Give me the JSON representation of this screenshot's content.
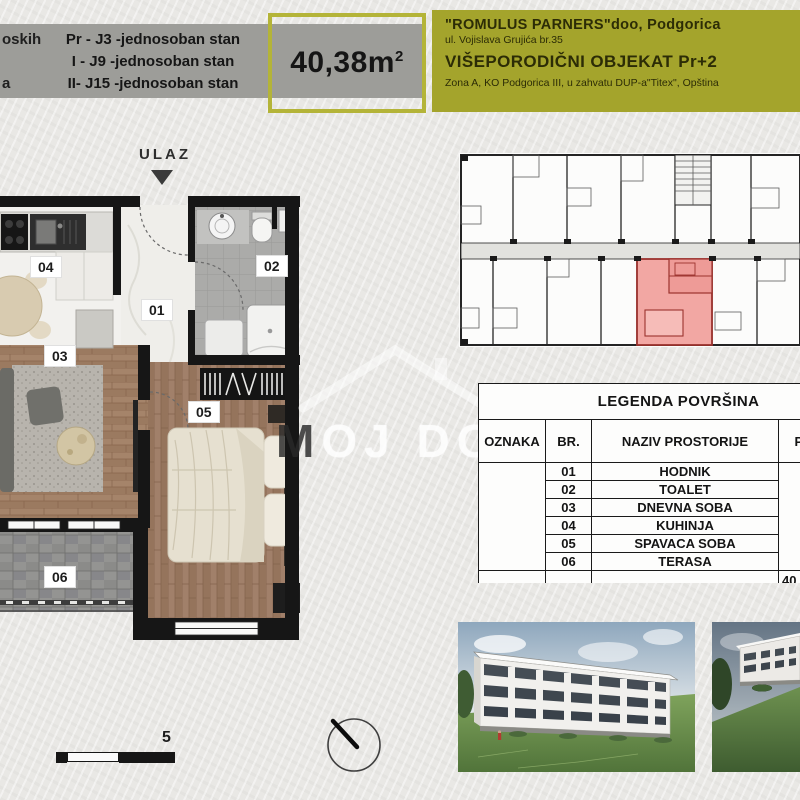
{
  "header": {
    "left_fragments": [
      "oskih",
      "a"
    ],
    "units": [
      "Pr - J3 -jednosoban stan",
      "I - J9 -jednosoban stan",
      "II- J15 -jednosoban stan"
    ],
    "area": {
      "value": "40,38m",
      "sup": "2"
    },
    "company": {
      "line1": "\"ROMULUS PARNERS\"doo, Podgorica",
      "line2": "ul. Vojislava Grujića br.35",
      "line3": "VIŠEPORODIČNI OBJEKAT  Pr+2",
      "line4": "Zona A, KO Podgorica III, u zahvatu DUP-a\"Titex\", Opština"
    },
    "colors": {
      "band_gray": "#9d9d99",
      "olive": "#a4a42c",
      "area_border": "#b4b438"
    }
  },
  "floorplan": {
    "entrance_label": "ULAZ",
    "rooms": [
      {
        "num": "01",
        "name": "HODNIK"
      },
      {
        "num": "02",
        "name": "TOALET"
      },
      {
        "num": "03",
        "name": "DNEVNA SOBA"
      },
      {
        "num": "04",
        "name": "KUHINJA"
      },
      {
        "num": "05",
        "name": "SPAVACA SOBA"
      },
      {
        "num": "06",
        "name": "TERASA"
      }
    ],
    "highlight_color": "#f2a7a3",
    "watermark_first": "M",
    "watermark_rest": "OJ DOM"
  },
  "legend": {
    "title": "LEGENDA POVRŠINA",
    "columns": [
      "OZNAKA",
      "BR.",
      "NAZIV PROSTORIJE",
      "POVRŠINA"
    ],
    "rows": [
      {
        "br": "01",
        "naziv": "HODNIK"
      },
      {
        "br": "02",
        "naziv": "TOALET"
      },
      {
        "br": "03",
        "naziv": "DNEVNA SOBA"
      },
      {
        "br": "04",
        "naziv": "KUHINJA"
      },
      {
        "br": "05",
        "naziv": "SPAVACA SOBA"
      },
      {
        "br": "06",
        "naziv": "TERASA"
      }
    ],
    "total": "40,38"
  },
  "scale": {
    "label": "5"
  }
}
